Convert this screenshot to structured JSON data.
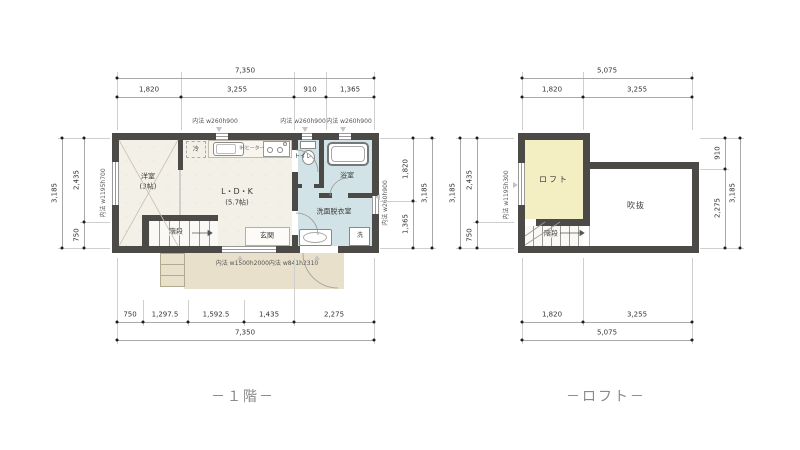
{
  "captions": {
    "floor1": "－１階－",
    "loft": "－ロフト－"
  },
  "floor1": {
    "rooms": {
      "yoshitsu_name": "洋室",
      "yoshitsu_size": "(3帖)",
      "ldk_name": "L・D・K",
      "ldk_size": "(5.7帖)",
      "genkan": "玄関",
      "toilet": "トイレ",
      "bath": "浴室",
      "senmen": "洗面脱衣室",
      "kaidan": "階段"
    },
    "fixtures": {
      "fridge": "冷",
      "washer": "洗",
      "stove": "IHヒーター"
    },
    "windows": {
      "top1": "内法 w260h900",
      "top2": "内法 w260h900",
      "top3": "内法 w260h900",
      "left": "内法 w1195h700",
      "right": "内法 w260h900",
      "bottom": "内法 w1500h2000内法 w841h2310"
    },
    "dims": {
      "top": {
        "total": "7,350",
        "segs": [
          "1,820",
          "3,255",
          "910",
          "1,365"
        ]
      },
      "bottom": {
        "total": "7,350",
        "segs": [
          "750",
          "1,297.5",
          "1,592.5",
          "1,435",
          "2,275"
        ]
      },
      "left": {
        "total": "3,185",
        "segs": [
          "2,435",
          "750"
        ]
      },
      "right": {
        "total": "3,185",
        "segs": [
          "1,820",
          "1,365"
        ]
      }
    }
  },
  "loft": {
    "rooms": {
      "loft": "ロフト",
      "void": "吹抜",
      "kaidan": "階段"
    },
    "windows": {
      "left": "内法 w1195h300"
    },
    "dims": {
      "top": {
        "total": "5,075",
        "segs": [
          "1,820",
          "3,255"
        ]
      },
      "bottom": {
        "total": "5,075",
        "segs": [
          "1,820",
          "3,255"
        ]
      },
      "left": {
        "total": "3,185",
        "segs": [
          "2,435",
          "750"
        ]
      },
      "right": {
        "total": "3,185",
        "segs": [
          "910",
          "2,275"
        ]
      }
    }
  },
  "colors": {
    "wall": "#4b4a47",
    "wet_room": "#d2e3e7",
    "loft_room": "#f4eec3",
    "porch": "#e9e0cb",
    "floor": "#f3f0e7",
    "caption_text": "#8a8a8a"
  }
}
